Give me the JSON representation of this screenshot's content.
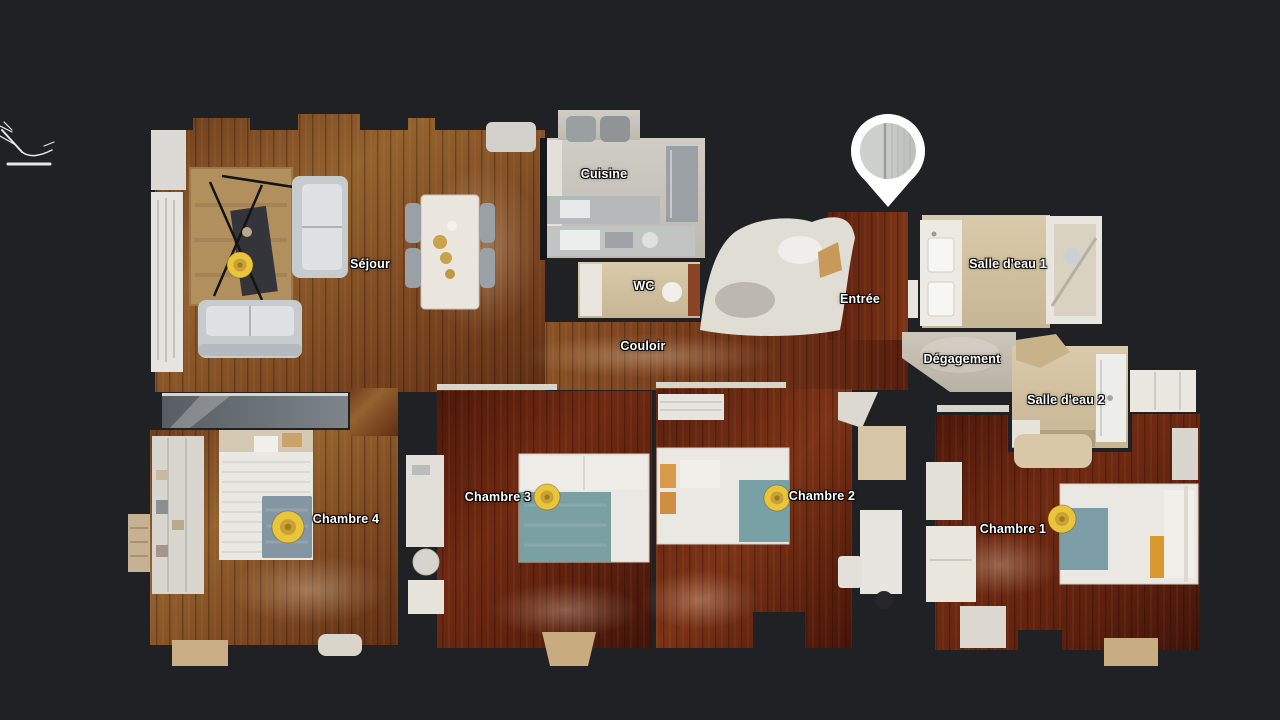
{
  "scene": {
    "background": "#1f2125",
    "palette": {
      "wood_light": "#8a5226",
      "wood_dark": "#5a1f0e",
      "tile": "#d2c6ab",
      "sweep_marker": "#e9c53d",
      "pin": "#ffffff",
      "label_text": "#ffffff"
    }
  },
  "rooms": [
    {
      "label": "Séjour",
      "x": 370,
      "y": 264
    },
    {
      "label": "Cuisine",
      "x": 604,
      "y": 174
    },
    {
      "label": "WC",
      "x": 644,
      "y": 286
    },
    {
      "label": "Couloir",
      "x": 643,
      "y": 346
    },
    {
      "label": "Entrée",
      "x": 860,
      "y": 299
    },
    {
      "label": "Salle d'eau 1",
      "x": 1008,
      "y": 264
    },
    {
      "label": "Dégagement",
      "x": 962,
      "y": 359
    },
    {
      "label": "Salle d'eau 2",
      "x": 1066,
      "y": 400
    },
    {
      "label": "Chambre 4",
      "x": 346,
      "y": 519
    },
    {
      "label": "Chambre 3",
      "x": 498,
      "y": 497
    },
    {
      "label": "Chambre 2",
      "x": 822,
      "y": 496
    },
    {
      "label": "Chambre 1",
      "x": 1013,
      "y": 529
    }
  ],
  "markers": {
    "pin": {
      "x": 888,
      "y": 151
    },
    "sweep_color": "#e9c53d",
    "sweeps": [
      {
        "x": 240,
        "y": 265,
        "r": 13
      },
      {
        "x": 288,
        "y": 527,
        "r": 16
      },
      {
        "x": 547,
        "y": 497,
        "r": 13
      },
      {
        "x": 777,
        "y": 498,
        "r": 13
      },
      {
        "x": 1062,
        "y": 519,
        "r": 14
      }
    ]
  }
}
